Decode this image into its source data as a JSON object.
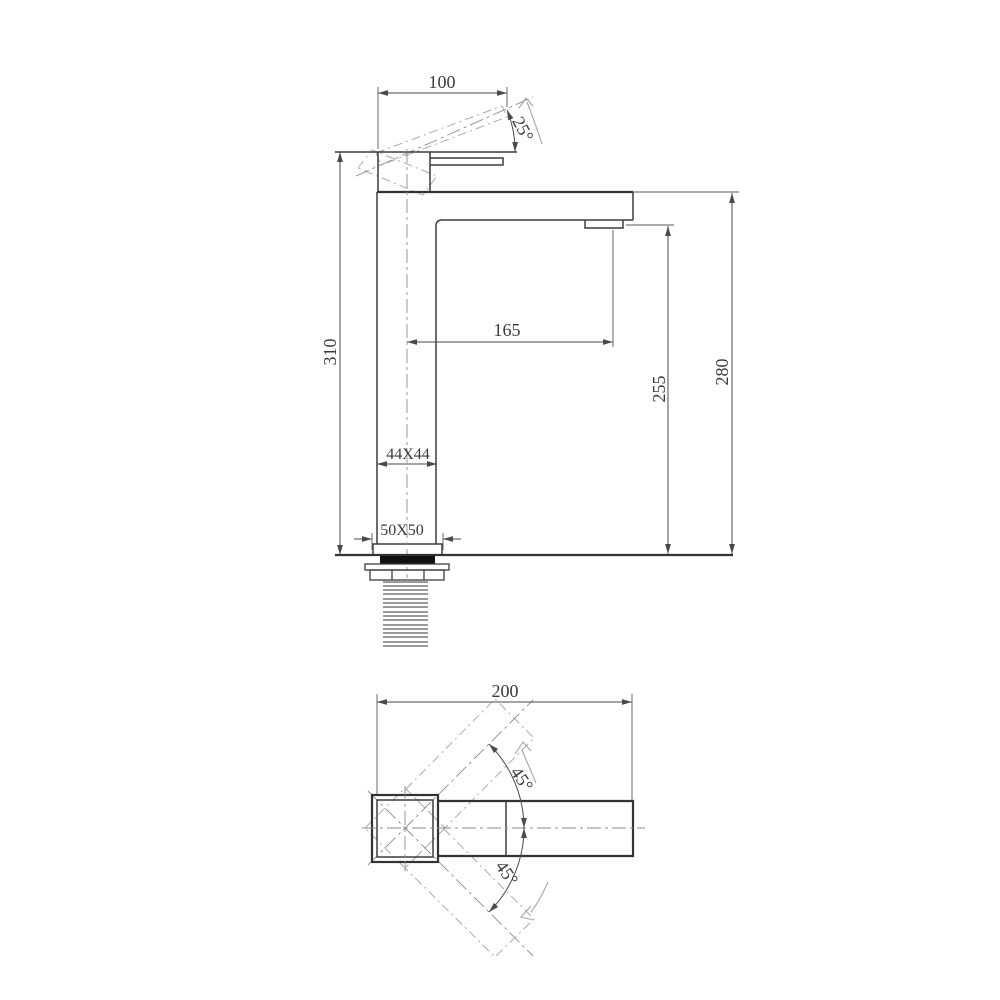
{
  "drawing": {
    "type": "technical-dimension-drawing",
    "subject": "tall square basin mixer faucet, side elevation and plan view",
    "side_view": {
      "dims": {
        "handle_width": "100",
        "handle_angle": "25°",
        "total_height": "310",
        "spout_reach": "165",
        "outlet_height": "255",
        "spout_height": "280",
        "body_section": "44X44",
        "base_section": "50X50"
      }
    },
    "plan_view": {
      "dims": {
        "overall_length": "200",
        "swivel_up": "45°",
        "swivel_down": "45°"
      }
    },
    "colors": {
      "line": "#3d3d3d",
      "dim_line": "#4a4a4a",
      "phantom": "#ababab",
      "centerline": "#8c8c8c",
      "gasket_fill": "#101010",
      "background": "#ffffff"
    }
  }
}
